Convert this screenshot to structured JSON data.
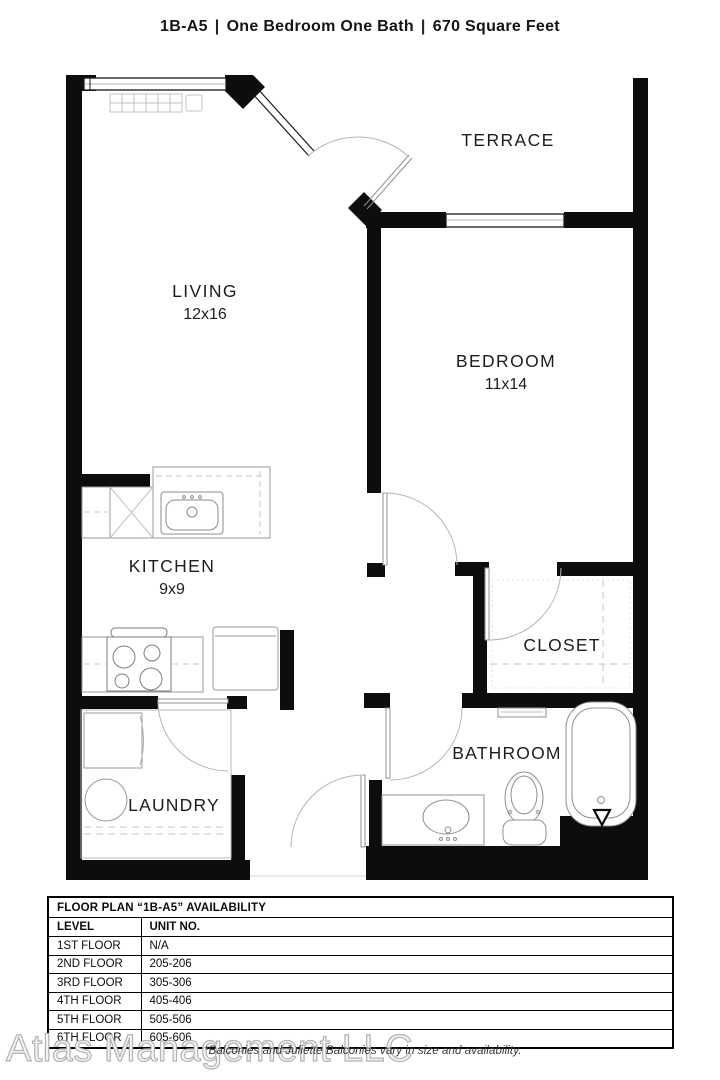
{
  "title": {
    "plan_code": "1B-A5",
    "separator": "|",
    "description": "One Bedroom One Bath",
    "area": "670 Square Feet"
  },
  "floor_plan": {
    "rooms": {
      "terrace": {
        "label": "TERRACE"
      },
      "living": {
        "label": "LIVING",
        "dimensions": "12x16"
      },
      "bedroom": {
        "label": "BEDROOM",
        "dimensions": "11x14"
      },
      "kitchen": {
        "label": "KITCHEN",
        "dimensions": "9x9"
      },
      "closet": {
        "label": "CLOSET"
      },
      "laundry": {
        "label": "LAUNDRY"
      },
      "bathroom": {
        "label": "BATHROOM"
      }
    }
  },
  "availability_table": {
    "title": "FLOOR PLAN “1B-A5” AVAILABILITY",
    "columns": [
      "LEVEL",
      "UNIT NO."
    ],
    "rows": [
      [
        "1ST FLOOR",
        "N/A"
      ],
      [
        "2ND FLOOR",
        "205-206"
      ],
      [
        "3RD FLOOR",
        "305-306"
      ],
      [
        "4TH FLOOR",
        "405-406"
      ],
      [
        "5TH FLOOR",
        "505-506"
      ],
      [
        "6TH FLOOR",
        "605-606"
      ]
    ]
  },
  "footer": {
    "watermark": "Atlas Management LLC",
    "note": "*Balconies and Juliette Balconies vary in size and availability."
  },
  "colors": {
    "wall": "#0d0d0d",
    "fixture": "#969696",
    "dashed": "#c6c6c6",
    "arc": "#b4b4b4"
  }
}
